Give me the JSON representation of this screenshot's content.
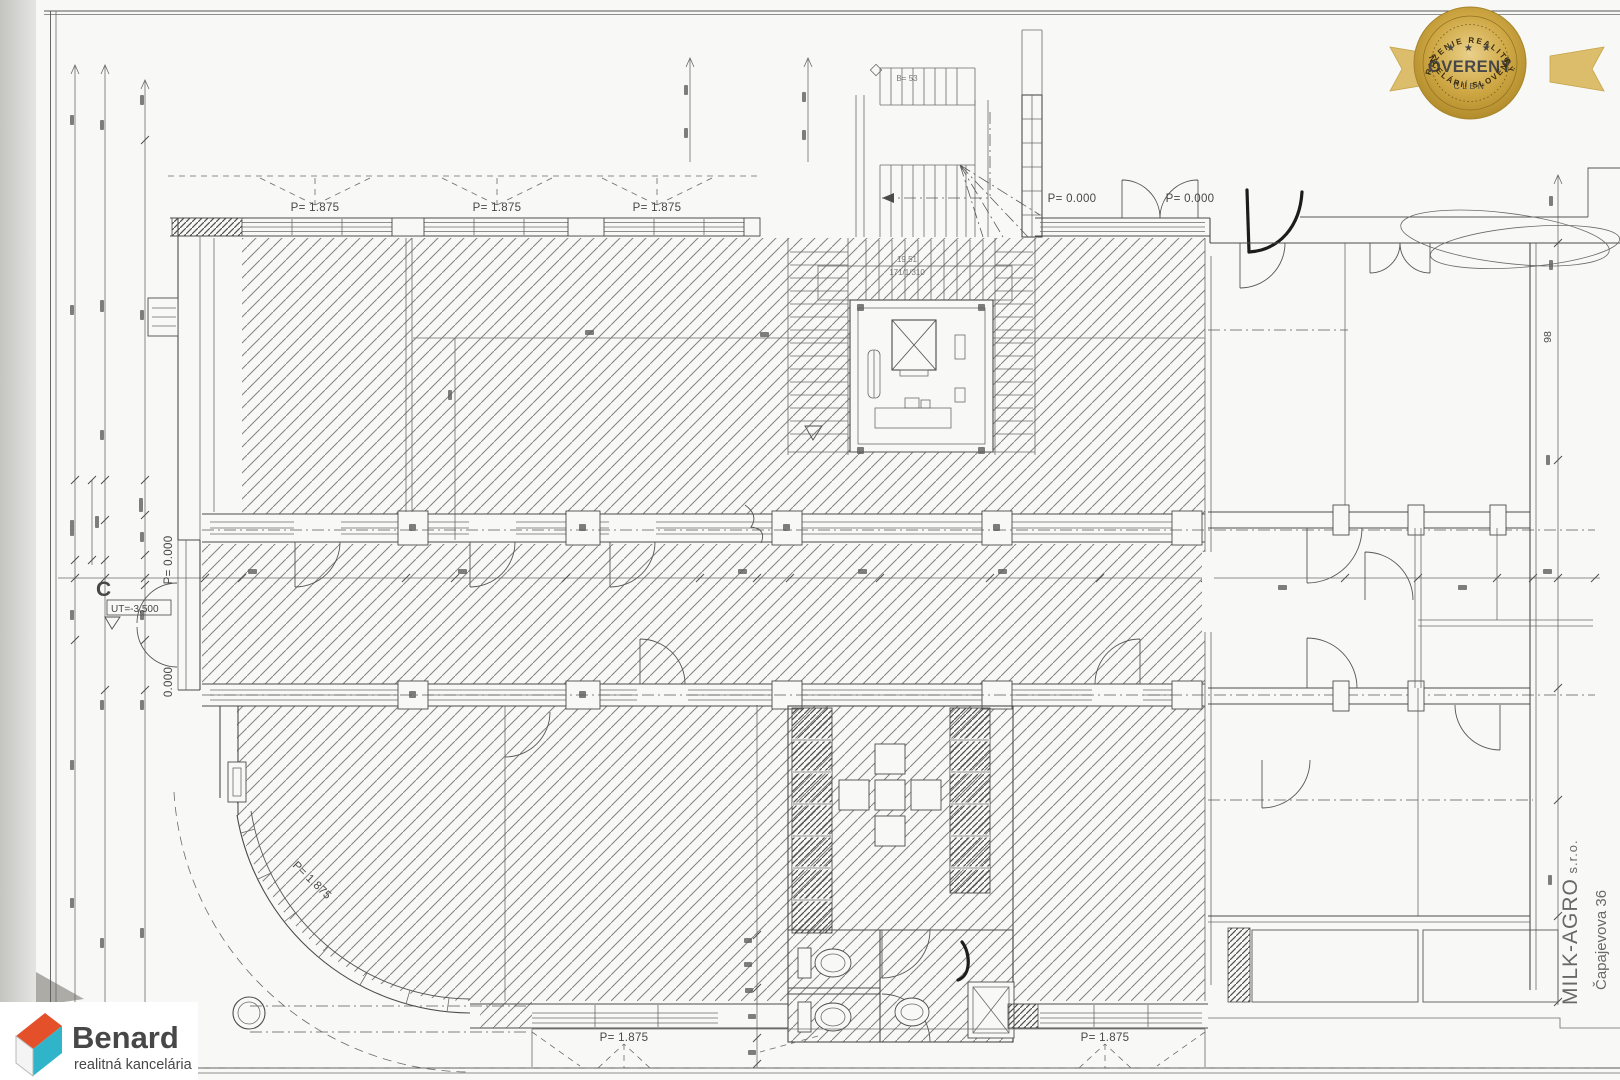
{
  "sheet": {
    "level_labels": {
      "parapet": "P= 1.875",
      "floor_zero": "P= 0.000",
      "floor_zero_partial": "0.000",
      "section_marker": "C",
      "terrain_level": "UT=-3,500",
      "axis_dim": "98"
    },
    "stair_labels": {
      "run_length": "19,51",
      "riser_formula": "171/1/310",
      "top_note": "B= 53"
    },
    "company_stamp": {
      "name": "MILK-AGRO",
      "suffix": " s.r.o.",
      "address": "Čapajevova 36"
    }
  },
  "badge": {
    "arc_top": "ZDRUŽENIE REALITNÝCH",
    "stars": "★ ★ ★",
    "title": "OVERENÝ",
    "member": "ČLEN",
    "arc_bottom": "KANCELÁRIÍ SLOVENSKA",
    "colors": {
      "gold": "#c9a23a",
      "gold_light": "#e6c878",
      "gold_dark": "#ad8726",
      "ribbon": "#dcbd6b",
      "text": "#2f2408"
    }
  },
  "logo": {
    "name": "Benard",
    "tagline": "realitná kancelária",
    "colors": {
      "orange": "#e4502a",
      "teal": "#2fb4c9",
      "text": "#1d2026",
      "tagline_text": "#3a3e45"
    }
  },
  "scan": {
    "paper": "#f8f8f6",
    "background": "#e3e3e1",
    "ink": "#4c4c4c"
  }
}
